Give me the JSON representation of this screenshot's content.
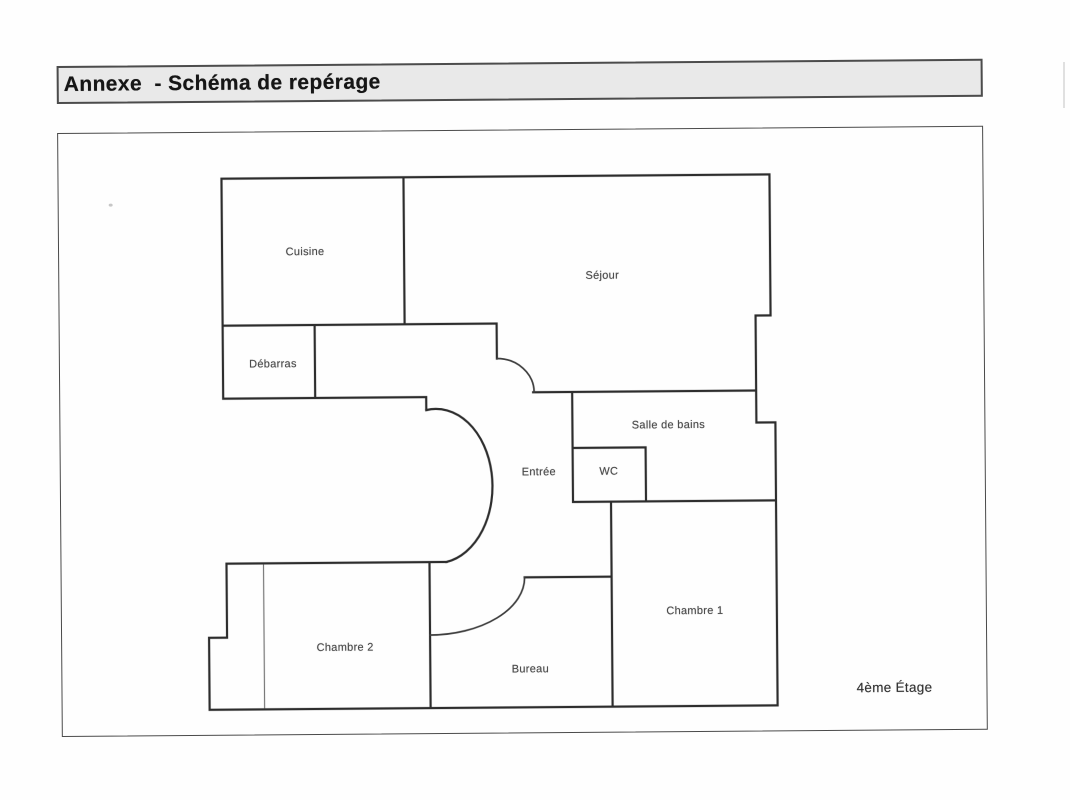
{
  "document": {
    "title": "Annexe  - Schéma de repérage"
  },
  "plan": {
    "rooms": [
      {
        "name": "cuisine",
        "label": "Cuisine"
      },
      {
        "name": "sejour",
        "label": "Séjour"
      },
      {
        "name": "debarras",
        "label": "Débarras"
      },
      {
        "name": "salle-de-bains",
        "label": "Salle de bains"
      },
      {
        "name": "entree",
        "label": "Entrée"
      },
      {
        "name": "wc",
        "label": "WC"
      },
      {
        "name": "chambre-1",
        "label": "Chambre 1"
      },
      {
        "name": "chambre-2",
        "label": "Chambre 2"
      },
      {
        "name": "bureau",
        "label": "Bureau"
      }
    ],
    "floor_label": "4ème Étage"
  },
  "colors": {
    "header_bg": "#e9e9e9",
    "header_border": "#4c4c4c",
    "box_border": "#4a4a4a",
    "wall": "#2d2d2d",
    "door_arc": "#3d3d3d",
    "partition": "#787878",
    "label_text": "#4b4b4b",
    "title_text": "#161616"
  }
}
